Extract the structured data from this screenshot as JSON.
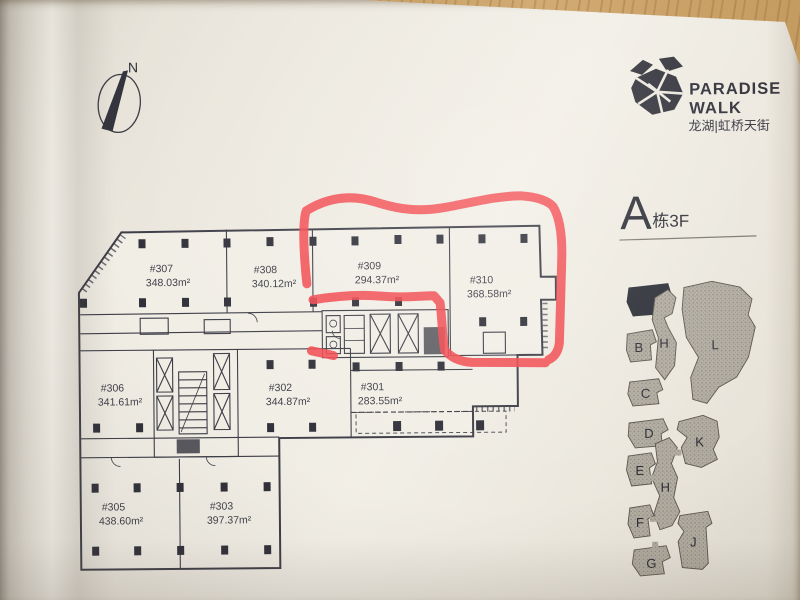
{
  "photo": {
    "north_label": "N"
  },
  "logo": {
    "line1": "PARADISE",
    "line2": "WALK",
    "subtitle": "龙湖|虹桥天街"
  },
  "title": {
    "building": "A",
    "suffix": "栋3F"
  },
  "plan": {
    "ink_color": "#3d3d47",
    "marker_color": "#f2494e",
    "rooms": [
      {
        "id": "#307",
        "area": "348.03m²"
      },
      {
        "id": "#308",
        "area": "340.12m²"
      },
      {
        "id": "#309",
        "area": "294.37m²"
      },
      {
        "id": "#310",
        "area": "368.58m²"
      },
      {
        "id": "#306",
        "area": "341.61m²"
      },
      {
        "id": "#302",
        "area": "344.87m²"
      },
      {
        "id": "#301",
        "area": "283.55m²"
      },
      {
        "id": "#305",
        "area": "438.60m²"
      },
      {
        "id": "#303",
        "area": "397.37m²"
      }
    ]
  },
  "sitemap": {
    "highlighted": "A",
    "labels": {
      "a": "A",
      "b": "B",
      "c": "C",
      "d": "D",
      "e": "E",
      "f": "F",
      "g": "G",
      "h_upper": "H",
      "h_lower": "H",
      "l": "L",
      "k": "K",
      "j": "J"
    }
  }
}
